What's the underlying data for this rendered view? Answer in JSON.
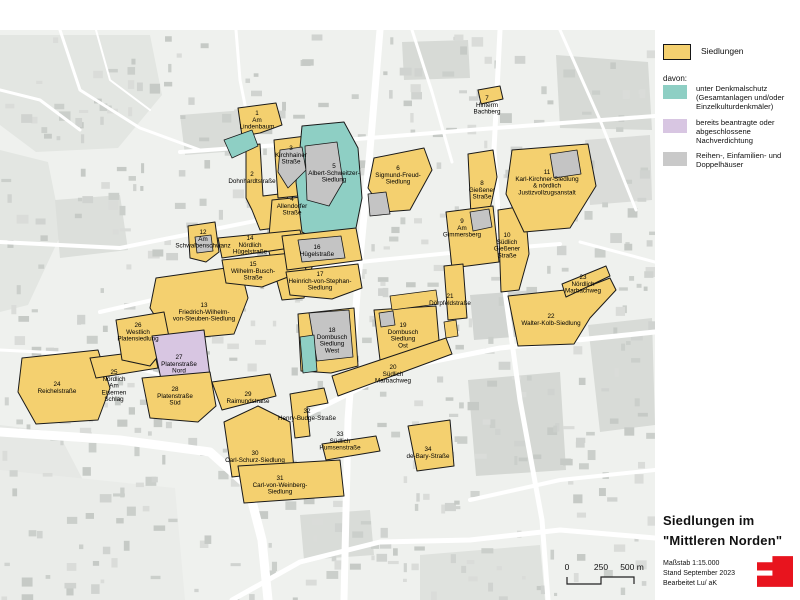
{
  "legend": {
    "siedlungen_label": "Siedlungen",
    "davon_label": "davon:",
    "items": [
      {
        "name": "denkmalschutz",
        "text": "unter Denkmalschutz\n(Gesamtanlagen und/oder\nEinzelkulturdenkmäler)"
      },
      {
        "name": "nachverdichtung",
        "text": "bereits beantragte oder\nabgeschlossene\nNachverdichtung"
      },
      {
        "name": "reihenhaeuser",
        "text": "Reihen-, Einfamilien- und\nDoppelhäuser"
      }
    ]
  },
  "title_block": {
    "line1": "Siedlungen im",
    "line2": "\"Mittleren Norden\"",
    "scale_label": "Maßstab 1:15.000",
    "stand_label": "Stand September 2023",
    "bearbeitet_label": "Bearbeitet  Lu/ aK"
  },
  "scalebar": {
    "labels": [
      "0",
      "250",
      "500 m"
    ]
  },
  "colors": {
    "settlement": "#F4D06F",
    "denkmalschutz": "#8ECFC4",
    "nachverdichtung": "#D8C6E2",
    "reihenhaus": "#C4C4C4",
    "outline": "#1a1a1a",
    "logo_red": "#E8141E"
  },
  "map": {
    "settlements": [
      {
        "num": "1",
        "name": "Am\nLindenbaum",
        "lx": 257,
        "ly": 115,
        "type": "yellow",
        "poly": "238,108 276,103 282,125 260,133 242,136"
      },
      {
        "num": "2",
        "name": "Dohnhardtstraße",
        "lx": 252,
        "ly": 176,
        "type": "yellow",
        "poly": "246,146 260,144 263,196 287,193 290,226 260,230 252,210 246,198"
      },
      {
        "num": "3",
        "name": "Kirchhainer\nStraße",
        "lx": 291,
        "ly": 150,
        "type": "yellow",
        "poly": "274,140 306,136 310,168 298,196 278,198"
      },
      {
        "num": "4",
        "name": "Allendorfer\nStraße",
        "lx": 292,
        "ly": 201,
        "type": "yellow",
        "poly": "272,200 312,196 318,244 304,298 282,300 268,248"
      },
      {
        "num": "5",
        "name": "Albert-Schweitzer-\nSiedlung",
        "lx": 334,
        "ly": 168,
        "type": "teal",
        "poly": "302,126 344,122 358,148 362,198 354,238 324,244 302,232 296,182 300,148"
      },
      {
        "num": "6",
        "name": "Sigmund-Freud-\nSiedlung",
        "lx": 398,
        "ly": 170,
        "type": "yellow",
        "poly": "374,158 424,148 432,170 410,210 384,212 368,188"
      },
      {
        "num": "7",
        "name": "Hinterm\nBachberg",
        "lx": 487,
        "ly": 100,
        "type": "yellow",
        "poly": "478,90 500,86 503,99 481,104"
      },
      {
        "num": "8",
        "name": "Gießener\nStraße",
        "lx": 482,
        "ly": 185,
        "type": "yellow",
        "poly": "468,154 493,150 497,177 489,214 471,216"
      },
      {
        "num": "9",
        "name": "Am\nGimmersberg",
        "lx": 462,
        "ly": 223,
        "type": "yellow",
        "poly": "446,212 493,206 499,262 452,268"
      },
      {
        "num": "10",
        "name": "Südlich\nGießener\nStraße",
        "lx": 507,
        "ly": 237,
        "type": "yellow",
        "poly": "498,210 525,206 529,254 519,290 501,292"
      },
      {
        "num": "11",
        "name": "Karl-Kirchner-Siedlung\n& nördlich\nJustizvollzugsanstalt",
        "lx": 547,
        "ly": 174,
        "type": "yellow",
        "poly": "512,150 588,144 596,186 570,228 524,232 506,194"
      },
      {
        "num": "12",
        "name": "Am\nSchwalbenschwanz",
        "lx": 203,
        "ly": 234,
        "type": "yellow",
        "poly": "188,226 215,222 219,252 206,262 190,258"
      },
      {
        "num": "13",
        "name": "Friedrich-Wilhelm-\nvon-Steuben-Siedlung",
        "lx": 204,
        "ly": 307,
        "type": "yellow",
        "poly": "156,278 240,266 248,298 234,334 170,340 150,308"
      },
      {
        "num": "14",
        "name": "Nördlich\nHügelstraße",
        "lx": 250,
        "ly": 240,
        "type": "yellow",
        "poly": "218,238 300,230 304,246 222,258"
      },
      {
        "num": "15",
        "name": "Wilhelm-Busch-\nStraße",
        "lx": 253,
        "ly": 266,
        "type": "yellow",
        "poly": "222,260 302,252 306,270 262,287 226,283"
      },
      {
        "num": "16",
        "name": "Hügelstraße",
        "lx": 317,
        "ly": 249,
        "type": "yellow",
        "poly": "282,236 356,228 362,260 287,270"
      },
      {
        "num": "17",
        "name": "Heinrich-von-Stephan-\nSiedlung",
        "lx": 320,
        "ly": 276,
        "type": "yellow",
        "poly": "286,272 358,264 362,288 332,299 290,295"
      },
      {
        "num": "18",
        "name": "Dornbusch\nSiedlung\nWest",
        "lx": 332,
        "ly": 332,
        "type": "yellow",
        "poly": "298,314 354,308 358,366 331,373 301,371"
      },
      {
        "num": "19",
        "name": "Dornbusch\nSiedlung\nOst",
        "lx": 403,
        "ly": 327,
        "type": "yellow",
        "poly": "374,310 436,306 440,352 380,360"
      },
      {
        "num": "20",
        "name": "Südlich\nMarbachweg",
        "lx": 393,
        "ly": 369,
        "type": "yellow",
        "poly": "332,376 446,338 452,354 338,396"
      },
      {
        "num": "21",
        "name": "Dörpfeldstraße",
        "lx": 450,
        "ly": 298,
        "type": "yellow",
        "poly": "444,266 463,264 467,318 448,320"
      },
      {
        "num": "22",
        "name": "Walter-Kolb-Siedlung",
        "lx": 551,
        "ly": 318,
        "type": "yellow",
        "poly": "508,296 584,288 610,278 616,290 590,318 574,344 518,346"
      },
      {
        "num": "23",
        "name": "Nördlich\nMarbachweg",
        "lx": 583,
        "ly": 279,
        "type": "yellow",
        "poly": "562,284 606,266 610,276 566,297"
      },
      {
        "num": "24",
        "name": "Reichelstraße",
        "lx": 57,
        "ly": 386,
        "type": "yellow",
        "poly": "22,358 98,350 110,388 98,420 36,424 18,392"
      },
      {
        "num": "25",
        "name": "Nördlich\nAm\nEisernen\nSchlag",
        "lx": 114,
        "ly": 374,
        "type": "yellow",
        "poly": "90,358 154,350 158,368 96,378"
      },
      {
        "num": "26",
        "name": "Westlich\nPlatensiedlung",
        "lx": 138,
        "ly": 327,
        "type": "yellow",
        "poly": "116,320 164,312 170,342 150,366 122,360"
      },
      {
        "num": "27",
        "name": "Platenstraße\nNord",
        "lx": 179,
        "ly": 359,
        "type": "purple",
        "poly": "152,336 204,330 210,376 162,384"
      },
      {
        "num": "28",
        "name": "Platenstraße\nSüd",
        "lx": 175,
        "ly": 391,
        "type": "yellow",
        "poly": "142,378 210,372 216,406 198,422 150,418"
      },
      {
        "num": "29",
        "name": "Raimundstraße",
        "lx": 248,
        "ly": 396,
        "type": "yellow",
        "poly": "212,382 270,374 276,396 222,410"
      },
      {
        "num": "30",
        "name": "Carl-Schurz-Siedlung",
        "lx": 255,
        "ly": 455,
        "type": "yellow",
        "poly": "224,422 258,406 290,422 294,470 232,477"
      },
      {
        "num": "31",
        "name": "Carl-von-Weinberg-\nSiedlung",
        "lx": 280,
        "ly": 480,
        "type": "yellow",
        "poly": "238,466 340,460 344,496 244,503"
      },
      {
        "num": "32",
        "name": "Henry-Budge-Straße",
        "lx": 307,
        "ly": 413,
        "type": "yellow",
        "poly": "290,394 324,388 328,403 307,407 310,436 295,438"
      },
      {
        "num": "33",
        "name": "Südlich\nHumsenstraße",
        "lx": 340,
        "ly": 436,
        "type": "yellow",
        "poly": "322,444 376,436 380,451 326,460"
      },
      {
        "num": "34",
        "name": "de-Bary-Straße",
        "lx": 428,
        "ly": 451,
        "type": "yellow",
        "poly": "408,426 450,420 454,466 417,471"
      }
    ],
    "overlays": [
      {
        "type": "teal",
        "poly": "224,140 252,130 258,146 232,158"
      },
      {
        "type": "gray",
        "poly": "280,150 302,147 306,170 288,188 278,172"
      },
      {
        "type": "gray",
        "poly": "305,146 337,142 343,182 329,206 307,200"
      },
      {
        "type": "gray",
        "poly": "368,194 386,192 390,214 370,216"
      },
      {
        "type": "gray",
        "poly": "470,212 489,209 492,227 473,231"
      },
      {
        "type": "gray",
        "poly": "550,154 577,150 581,174 554,178"
      },
      {
        "type": "gray",
        "poly": "195,237 211,235 213,251 197,253"
      },
      {
        "type": "gray",
        "poly": "298,240 341,236 345,258 302,262"
      },
      {
        "type": "gray",
        "poly": "309,313 349,310 353,357 317,361"
      },
      {
        "type": "teal",
        "poly": "300,337 314,335 317,371 303,373"
      },
      {
        "type": "gray",
        "poly": "379,313 393,311 395,325 381,327"
      },
      {
        "type": "yellow",
        "poly": "444,322 456,320 458,336 446,338"
      },
      {
        "type": "yellow",
        "poly": "390,296 436,290 438,304 392,310"
      }
    ]
  }
}
